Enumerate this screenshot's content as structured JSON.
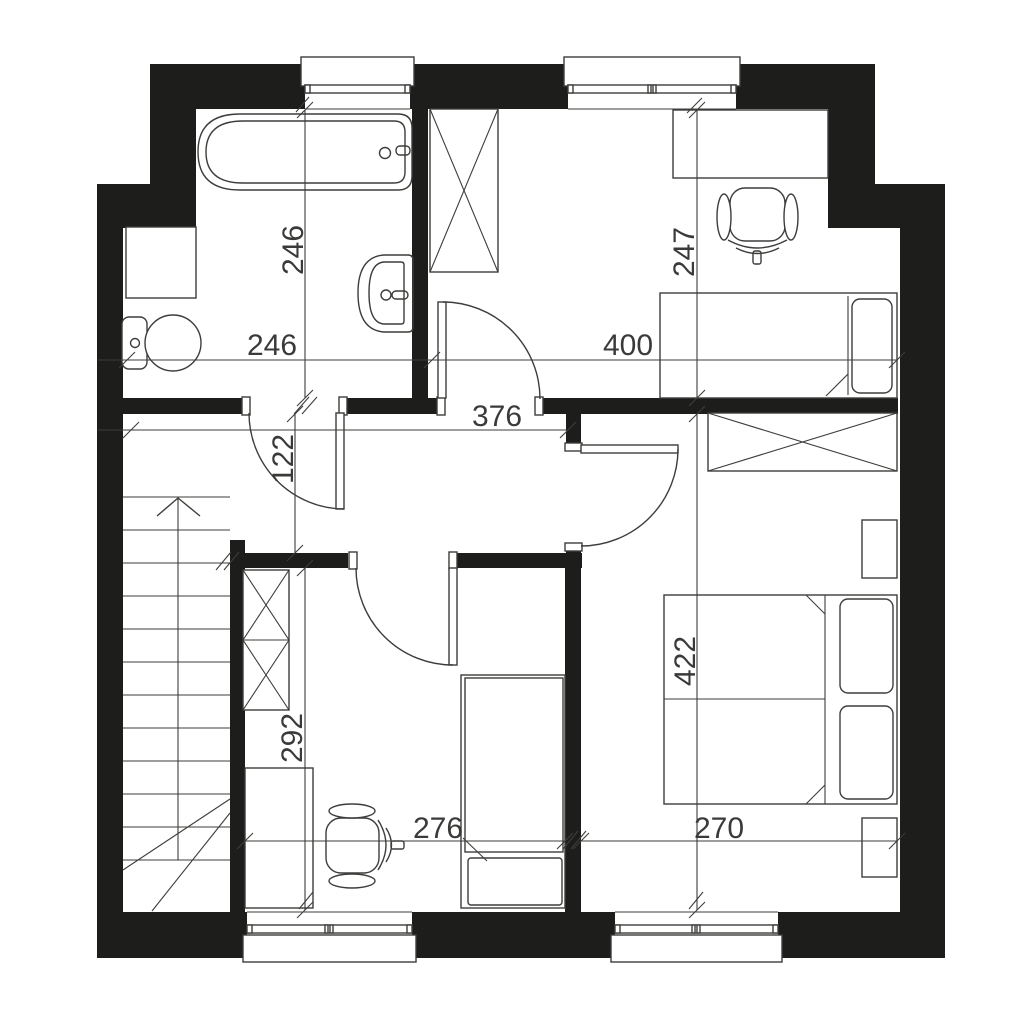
{
  "meta": {
    "type": "architectural-floor-plan",
    "canvas": {
      "w": 1024,
      "h": 1024
    }
  },
  "colors": {
    "bg": "#ffffff",
    "wall": "#1d1d1b",
    "line": "#3d3d3b",
    "dim": "#3a3a39"
  },
  "rooms": [
    {
      "name": "bathroom",
      "width_label": "246",
      "height_label": "246"
    },
    {
      "name": "bedroom-top-right",
      "width_label": "400",
      "height_label": "247"
    },
    {
      "name": "hallway",
      "width_label": "376",
      "height_label": "122"
    },
    {
      "name": "bedroom-bottom-middle",
      "width_label": "276",
      "height_label": "292"
    },
    {
      "name": "bedroom-bottom-right",
      "width_label": "270",
      "height_label": "422"
    }
  ],
  "plan": {
    "walls": [
      [
        150,
        64,
        155,
        45,
        "wall-top-left"
      ],
      [
        410,
        64,
        158,
        45,
        "wall-top-middle"
      ],
      [
        736,
        64,
        139,
        45,
        "wall-top-right"
      ],
      [
        150,
        64,
        46,
        120,
        "wall-left-upper"
      ],
      [
        97,
        184,
        99,
        44,
        "wall-left-step"
      ],
      [
        97,
        228,
        26,
        730,
        "wall-left-lower"
      ],
      [
        97,
        912,
        150,
        46,
        "wall-bottom-left"
      ],
      [
        412,
        912,
        203,
        46,
        "wall-bottom-middle"
      ],
      [
        778,
        912,
        167,
        46,
        "wall-bottom-right"
      ],
      [
        900,
        228,
        45,
        730,
        "wall-right-lower"
      ],
      [
        875,
        184,
        70,
        44,
        "wall-right-step"
      ],
      [
        828,
        109,
        47,
        119,
        "wall-right-upper"
      ],
      [
        412,
        109,
        16,
        290,
        "wall-bathroom-bedroom1"
      ],
      [
        123,
        398,
        125,
        16,
        "wall-hallway-a"
      ],
      [
        343,
        398,
        102,
        16,
        "wall-hallway-b"
      ],
      [
        535,
        398,
        363,
        16,
        "wall-hallway-c"
      ],
      [
        566,
        398,
        15,
        47,
        "wall-bedroom3-stub"
      ],
      [
        566,
        549,
        15,
        20,
        "wall-bedroom3-lower-stub"
      ],
      [
        230,
        553,
        118,
        15,
        "wall-bedroom2-top-a"
      ],
      [
        457,
        553,
        125,
        15,
        "wall-bedroom2-top-b"
      ],
      [
        565,
        568,
        16,
        344,
        "wall-bedroom2-bedroom3"
      ],
      [
        230,
        540,
        15,
        372,
        "wall-stairs-bedroom2"
      ]
    ],
    "outlined_rects": [
      [
        242,
        397,
        8,
        18,
        0,
        "door-jamb-bathroom-left"
      ],
      [
        339,
        397,
        8,
        18,
        0,
        "door-jamb-bathroom-right"
      ],
      [
        437,
        397,
        8,
        18,
        0,
        "door-jamb-bedroom1-left"
      ],
      [
        535,
        397,
        8,
        18,
        0,
        "door-jamb-bedroom1-right"
      ],
      [
        349,
        552,
        8,
        17,
        0,
        "door-jamb-bedroom2-left"
      ],
      [
        449,
        552,
        8,
        17,
        0,
        "door-jamb-bedroom2-right"
      ],
      [
        565,
        443,
        17,
        8,
        0,
        "door-jamb-bedroom3-top"
      ],
      [
        565,
        543,
        17,
        8,
        0,
        "door-jamb-bedroom3-bottom"
      ],
      [
        336,
        413,
        8,
        96,
        0,
        "door-leaf-bathroom"
      ],
      [
        438,
        302,
        8,
        96,
        0,
        "door-leaf-bedroom1"
      ],
      [
        449,
        568,
        8,
        97,
        0,
        "door-leaf-bedroom2"
      ],
      [
        581,
        445,
        97,
        8,
        0,
        "door-leaf-bedroom3"
      ],
      [
        301,
        57,
        113,
        29,
        0,
        "window-sill-bathroom"
      ],
      [
        564,
        57,
        176,
        29,
        0,
        "window-sill-bedroom1"
      ],
      [
        243,
        935,
        173,
        27,
        0,
        "window-sill-bedroom2"
      ],
      [
        611,
        935,
        171,
        27,
        0,
        "window-sill-bedroom3"
      ],
      [
        305,
        85,
        105,
        8,
        0,
        "window-frame-bathroom"
      ],
      [
        568,
        85,
        168,
        8,
        0,
        "window-frame-bedroom1"
      ],
      [
        247,
        925,
        165,
        8,
        0,
        "window-frame-bedroom2"
      ],
      [
        615,
        925,
        163,
        8,
        0,
        "window-frame-bedroom3"
      ],
      [
        305,
        85,
        5,
        8,
        0,
        "window-tick"
      ],
      [
        405,
        85,
        5,
        8,
        0,
        "window-tick"
      ],
      [
        568,
        85,
        5,
        8,
        0,
        "window-tick"
      ],
      [
        731,
        85,
        5,
        8,
        0,
        "window-tick"
      ],
      [
        648,
        85,
        3,
        8,
        0,
        "window-tick"
      ],
      [
        653,
        85,
        3,
        8,
        0,
        "window-tick"
      ],
      [
        247,
        925,
        5,
        8,
        0,
        "window-tick"
      ],
      [
        407,
        925,
        5,
        8,
        0,
        "window-tick"
      ],
      [
        325,
        925,
        3,
        8,
        0,
        "window-tick"
      ],
      [
        330,
        925,
        3,
        8,
        0,
        "window-tick"
      ],
      [
        615,
        925,
        5,
        8,
        0,
        "window-tick"
      ],
      [
        773,
        925,
        5,
        8,
        0,
        "window-tick"
      ],
      [
        692,
        925,
        3,
        8,
        0,
        "window-tick"
      ],
      [
        697,
        925,
        3,
        8,
        0,
        "window-tick"
      ],
      [
        126,
        227,
        70,
        71,
        0,
        "washing-machine"
      ],
      [
        122,
        317,
        25,
        52,
        7,
        "toilet-cistern"
      ],
      [
        430,
        109,
        68,
        163,
        0,
        "wardrobe-bedroom1"
      ],
      [
        673,
        110,
        155,
        68,
        0,
        "desk-bedroom1"
      ],
      [
        730,
        188,
        55,
        53,
        15,
        "desk-chair-seat-bedroom1"
      ],
      [
        753,
        251,
        8,
        13,
        2,
        "desk-chair-stem-bedroom1"
      ],
      [
        660,
        293,
        237,
        105,
        0,
        "bed-frame-bedroom1"
      ],
      [
        852,
        299,
        40,
        94,
        8,
        "bed-pillow-bedroom1"
      ],
      [
        243,
        570,
        46,
        140,
        0,
        "wardrobe-bedroom2"
      ],
      [
        245,
        768,
        68,
        140,
        0,
        "desk-bedroom2"
      ],
      [
        326,
        818,
        53,
        55,
        15,
        "desk-chair-seat-bedroom2"
      ],
      [
        391,
        841,
        13,
        8,
        2,
        "desk-chair-stem-bedroom2"
      ],
      [
        461,
        675,
        104,
        233,
        0,
        "bed-frame-bedroom2"
      ],
      [
        465,
        678,
        98,
        174,
        0,
        "bed-mattress-bedroom2"
      ],
      [
        468,
        858,
        94,
        47,
        3,
        "bed-pillow-bedroom2"
      ],
      [
        708,
        413,
        189,
        58,
        0,
        "wardrobe-bedroom3"
      ],
      [
        862,
        520,
        35,
        58,
        0,
        "nightstand-top-bedroom3"
      ],
      [
        862,
        818,
        35,
        59,
        0,
        "nightstand-bottom-bedroom3"
      ],
      [
        664,
        595,
        233,
        209,
        0,
        "double-bed-frame-bedroom3"
      ],
      [
        840,
        599,
        53,
        94,
        8,
        "double-bed-pillow-top"
      ],
      [
        840,
        706,
        53,
        93,
        8,
        "double-bed-pillow-bottom"
      ],
      [
        396,
        146,
        14,
        9,
        4,
        "bathtub-faucet"
      ],
      [
        392,
        291,
        16,
        8,
        4,
        "sink-faucet"
      ]
    ],
    "paths": [
      [
        "M249,413 A96,96 0 0 0 344,509",
        "door-arc-bathroom"
      ],
      [
        "M443,302 A97,97 0 0 1 540,399",
        "door-arc-bedroom1"
      ],
      [
        "M453,665 A97,97 0 0 1 356,568",
        "door-arc-bedroom2"
      ],
      [
        "M678,449 A97,97 0 0 1 581,546",
        "door-arc-bedroom3"
      ],
      [
        "M240,114 H398 Q412,114 412,128 V176 Q412,190 398,190 H240 Q198,190 198,152 Q198,114 240,114 Z",
        "bathtub-outer"
      ],
      [
        "M243,121 H394 Q405,121 405,132 V172 Q405,183 394,183 H243 Q206,183 206,152 Q206,121 243,121 Z",
        "bathtub-inner"
      ],
      [
        "M408,255 Q413,255 413,260 V327 Q413,332 408,332 H384 Q358,330 358,293 Q358,257 384,255 Z",
        "sink-outer"
      ],
      [
        "M401,262 H384 Q369,263 369,293 Q369,323 384,324 H401 Q404,324 404,321 V265 Q404,262 401,262 Z",
        "sink-basin"
      ],
      [
        "M728,240 Q757,256 787,240",
        "desk-chair-back-bedroom1"
      ],
      [
        "M736,248 Q757,259 779,248",
        "desk-chair-base-bedroom1"
      ],
      [
        "M378,820 Q394,845 378,870",
        "desk-chair-back-bedroom2"
      ],
      [
        "M386,828 Q397,845 386,862",
        "desk-chair-base-bedroom2"
      ],
      [
        "M157,516 L178,498 L200,516",
        "stairs-direction-arrow"
      ]
    ],
    "ellipses": [
      [
        173,
        343,
        28,
        28,
        "toilet-bowl"
      ],
      [
        724,
        217,
        7,
        23,
        "chair1-armrest-left"
      ],
      [
        791,
        217,
        7,
        23,
        "chair1-armrest-right"
      ],
      [
        352,
        811,
        23,
        7,
        "chair2-armrest-top"
      ],
      [
        352,
        881,
        23,
        7,
        "chair2-armrest-bottom"
      ]
    ],
    "circles": [
      [
        135,
        343,
        4.5,
        "toilet-flush-button"
      ],
      [
        385,
        153,
        5.5,
        "bathtub-drain"
      ],
      [
        386,
        295,
        5,
        "sink-drain"
      ]
    ],
    "lines": [
      [
        430,
        109,
        498,
        272,
        "wardrobe1-x"
      ],
      [
        498,
        109,
        430,
        272,
        "wardrobe1-x"
      ],
      [
        243,
        570,
        289,
        640,
        "wardrobe2-x"
      ],
      [
        289,
        570,
        243,
        640,
        "wardrobe2-x"
      ],
      [
        243,
        640,
        289,
        710,
        "wardrobe2-x"
      ],
      [
        289,
        640,
        243,
        710,
        "wardrobe2-x"
      ],
      [
        243,
        640,
        289,
        640,
        "wardrobe2-divider"
      ],
      [
        708,
        413,
        897,
        471,
        "wardrobe3-x"
      ],
      [
        897,
        413,
        708,
        471,
        "wardrobe3-x"
      ],
      [
        848,
        296,
        848,
        395,
        "bed1-headboard-line"
      ],
      [
        826,
        396,
        848,
        374,
        "bed1-duvet-fold"
      ],
      [
        825,
        595,
        825,
        804,
        "bed3-headboard-line"
      ],
      [
        664,
        699,
        825,
        699,
        "bed3-mattress-divider"
      ],
      [
        806,
        595,
        825,
        614,
        "bed3-duvet-fold-top"
      ],
      [
        806,
        804,
        825,
        785,
        "bed3-duvet-fold-bottom"
      ],
      [
        463,
        838,
        487,
        861,
        "bed2-duvet-fold"
      ],
      [
        305,
        109,
        410,
        109,
        "window-inner-edge"
      ],
      [
        568,
        109,
        736,
        109,
        "window-inner-edge"
      ],
      [
        247,
        912,
        412,
        912,
        "window-inner-edge"
      ],
      [
        615,
        912,
        778,
        912,
        "window-inner-edge"
      ],
      [
        296,
        112,
        309,
        97,
        "window-opening-mark"
      ],
      [
        687,
        113,
        702,
        98,
        "window-opening-mark"
      ],
      [
        299,
        909,
        313,
        892,
        "window-opening-mark"
      ],
      [
        689,
        909,
        703,
        892,
        "window-opening-mark"
      ],
      [
        123,
        497,
        230,
        497,
        "stair-tread"
      ],
      [
        123,
        530,
        230,
        530,
        "stair-tread"
      ],
      [
        123,
        563,
        230,
        563,
        "stair-tread"
      ],
      [
        123,
        596,
        230,
        596,
        "stair-tread"
      ],
      [
        123,
        629,
        230,
        629,
        "stair-tread"
      ],
      [
        123,
        662,
        230,
        662,
        "stair-tread"
      ],
      [
        123,
        695,
        230,
        695,
        "stair-tread"
      ],
      [
        123,
        728,
        230,
        728,
        "stair-tread"
      ],
      [
        123,
        761,
        230,
        761,
        "stair-tread"
      ],
      [
        123,
        794,
        230,
        794,
        "stair-tread"
      ],
      [
        123,
        827,
        230,
        827,
        "stair-tread"
      ],
      [
        123,
        860,
        230,
        860,
        "stair-tread"
      ],
      [
        178,
        497,
        178,
        860,
        "stair-center-line"
      ],
      [
        123,
        870,
        230,
        799,
        "stair-break-line"
      ],
      [
        152,
        911,
        230,
        813,
        "stair-break-line"
      ],
      [
        98,
        360,
        897,
        360,
        "dim-line-top-horizontal"
      ],
      [
        98,
        430,
        567,
        430,
        "dim-line-hallway"
      ],
      [
        295,
        413,
        295,
        553,
        "dim-line-hallway-height"
      ],
      [
        305,
        110,
        305,
        398,
        "dim-line-bathroom-height"
      ],
      [
        697,
        110,
        697,
        398,
        "dim-line-bedroom1-height"
      ],
      [
        305,
        568,
        305,
        910,
        "dim-line-bedroom2-height"
      ],
      [
        697,
        414,
        697,
        910,
        "dim-line-bedroom3-height"
      ],
      [
        245,
        841,
        565,
        841,
        "dim-line-bedroom2-width"
      ],
      [
        581,
        841,
        897,
        841,
        "dim-line-bedroom3-width"
      ],
      [
        119,
        368,
        135,
        352,
        "dim-tick"
      ],
      [
        424,
        368,
        440,
        352,
        "dim-tick"
      ],
      [
        889,
        368,
        905,
        352,
        "dim-tick"
      ],
      [
        123,
        438,
        139,
        422,
        "dim-tick"
      ],
      [
        560,
        438,
        576,
        422,
        "dim-tick"
      ],
      [
        287,
        422,
        303,
        406,
        "dim-tick"
      ],
      [
        287,
        561,
        303,
        545,
        "dim-tick"
      ],
      [
        297,
        118,
        313,
        102,
        "dim-tick"
      ],
      [
        297,
        406,
        313,
        390,
        "dim-tick"
      ],
      [
        689,
        118,
        705,
        102,
        "dim-tick"
      ],
      [
        689,
        406,
        705,
        390,
        "dim-tick"
      ],
      [
        297,
        576,
        313,
        560,
        "dim-tick"
      ],
      [
        297,
        918,
        313,
        902,
        "dim-tick"
      ],
      [
        689,
        422,
        705,
        406,
        "dim-tick"
      ],
      [
        689,
        918,
        705,
        902,
        "dim-tick"
      ],
      [
        237,
        849,
        253,
        833,
        "dim-tick"
      ],
      [
        557,
        849,
        573,
        833,
        "dim-tick"
      ],
      [
        573,
        849,
        589,
        833,
        "dim-tick"
      ],
      [
        889,
        849,
        905,
        833,
        "dim-tick"
      ],
      [
        294,
        414,
        309,
        397,
        "wall-break-mark"
      ],
      [
        302,
        414,
        317,
        397,
        "wall-break-mark"
      ],
      [
        216,
        570,
        231,
        552,
        "wall-break-mark"
      ],
      [
        224,
        570,
        239,
        552,
        "wall-break-mark"
      ],
      [
        563,
        849,
        578,
        831,
        "wall-break-mark"
      ],
      [
        571,
        849,
        586,
        831,
        "wall-break-mark"
      ]
    ],
    "labels": [
      [
        "246",
        272,
        355,
        0,
        "dim-label-bathroom-width"
      ],
      [
        "400",
        628,
        355,
        0,
        "dim-label-bedroom1-width"
      ],
      [
        "376",
        497,
        426,
        0,
        "dim-label-hallway-width"
      ],
      [
        "276",
        438,
        838,
        0,
        "dim-label-bedroom2-width"
      ],
      [
        "270",
        719,
        838,
        0,
        "dim-label-bedroom3-width"
      ],
      [
        "246",
        303,
        250,
        -90,
        "dim-label-bathroom-height"
      ],
      [
        "247",
        694,
        252,
        -90,
        "dim-label-bedroom1-height"
      ],
      [
        "122",
        293,
        459,
        -90,
        "dim-label-hallway-height"
      ],
      [
        "292",
        302,
        738,
        -90,
        "dim-label-bedroom2-height"
      ],
      [
        "422",
        695,
        661,
        -90,
        "dim-label-bedroom3-height"
      ]
    ]
  }
}
